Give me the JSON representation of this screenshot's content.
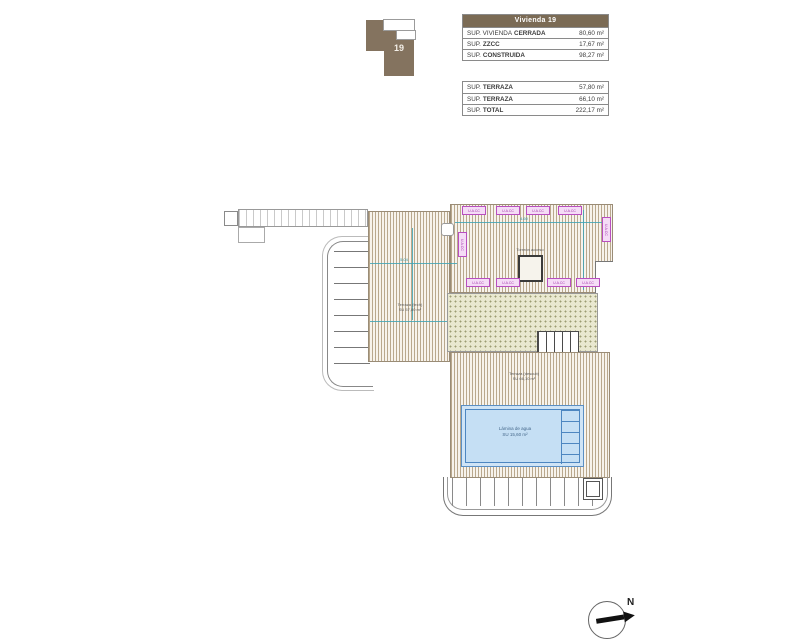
{
  "key_plan": {
    "unit_number": "19"
  },
  "summary_table": {
    "header": "Vivienda 19",
    "built_rows": [
      {
        "prefix": "SUP. VIVIENDA",
        "name": "CERRADA",
        "value": "80,60 m²"
      },
      {
        "prefix": "SUP.",
        "name": "ZZCC",
        "value": "17,67 m²"
      },
      {
        "prefix": "SUP.",
        "name": "CONSTRUIDA",
        "value": "98,27 m²"
      }
    ],
    "terrace_rows": [
      {
        "prefix": "SUP.",
        "name": "TERRAZA",
        "value": "57,80 m²"
      },
      {
        "prefix": "SUP.",
        "name": "TERRAZA",
        "value": "66,10 m²"
      },
      {
        "prefix": "SUP.",
        "name": "TOTAL",
        "value": "222,17 m²"
      }
    ]
  },
  "plan": {
    "ac_unit_label": "U.A.CC",
    "skylight_label": "Torreón acceso",
    "upper_terrace_label": {
      "line1": "Terraza (tech)",
      "line2": "SU 57,80 m²"
    },
    "lower_terrace_label": {
      "line1": "Terraza (descub)",
      "line2": "SU 66,10 m²"
    },
    "pool_label": {
      "line1": "Lámina de agua",
      "line2": "SU 15,60 m²"
    },
    "dimensions": {
      "d1": "4.60",
      "d2": "5.04",
      "d3": "6.00",
      "d4": "1.26"
    }
  },
  "compass": {
    "north_label": "N"
  },
  "colors": {
    "header_brown": "#7b6b55",
    "key_plan_brown": "#84735f",
    "deck_hatch": "#b9a88d",
    "green_area": "#e9e8d0",
    "pool_fill": "#c5dff4",
    "pool_border": "#4d86c0",
    "ac_label_magenta": "#b84fc0",
    "dimension_teal": "#3fa3b5"
  }
}
